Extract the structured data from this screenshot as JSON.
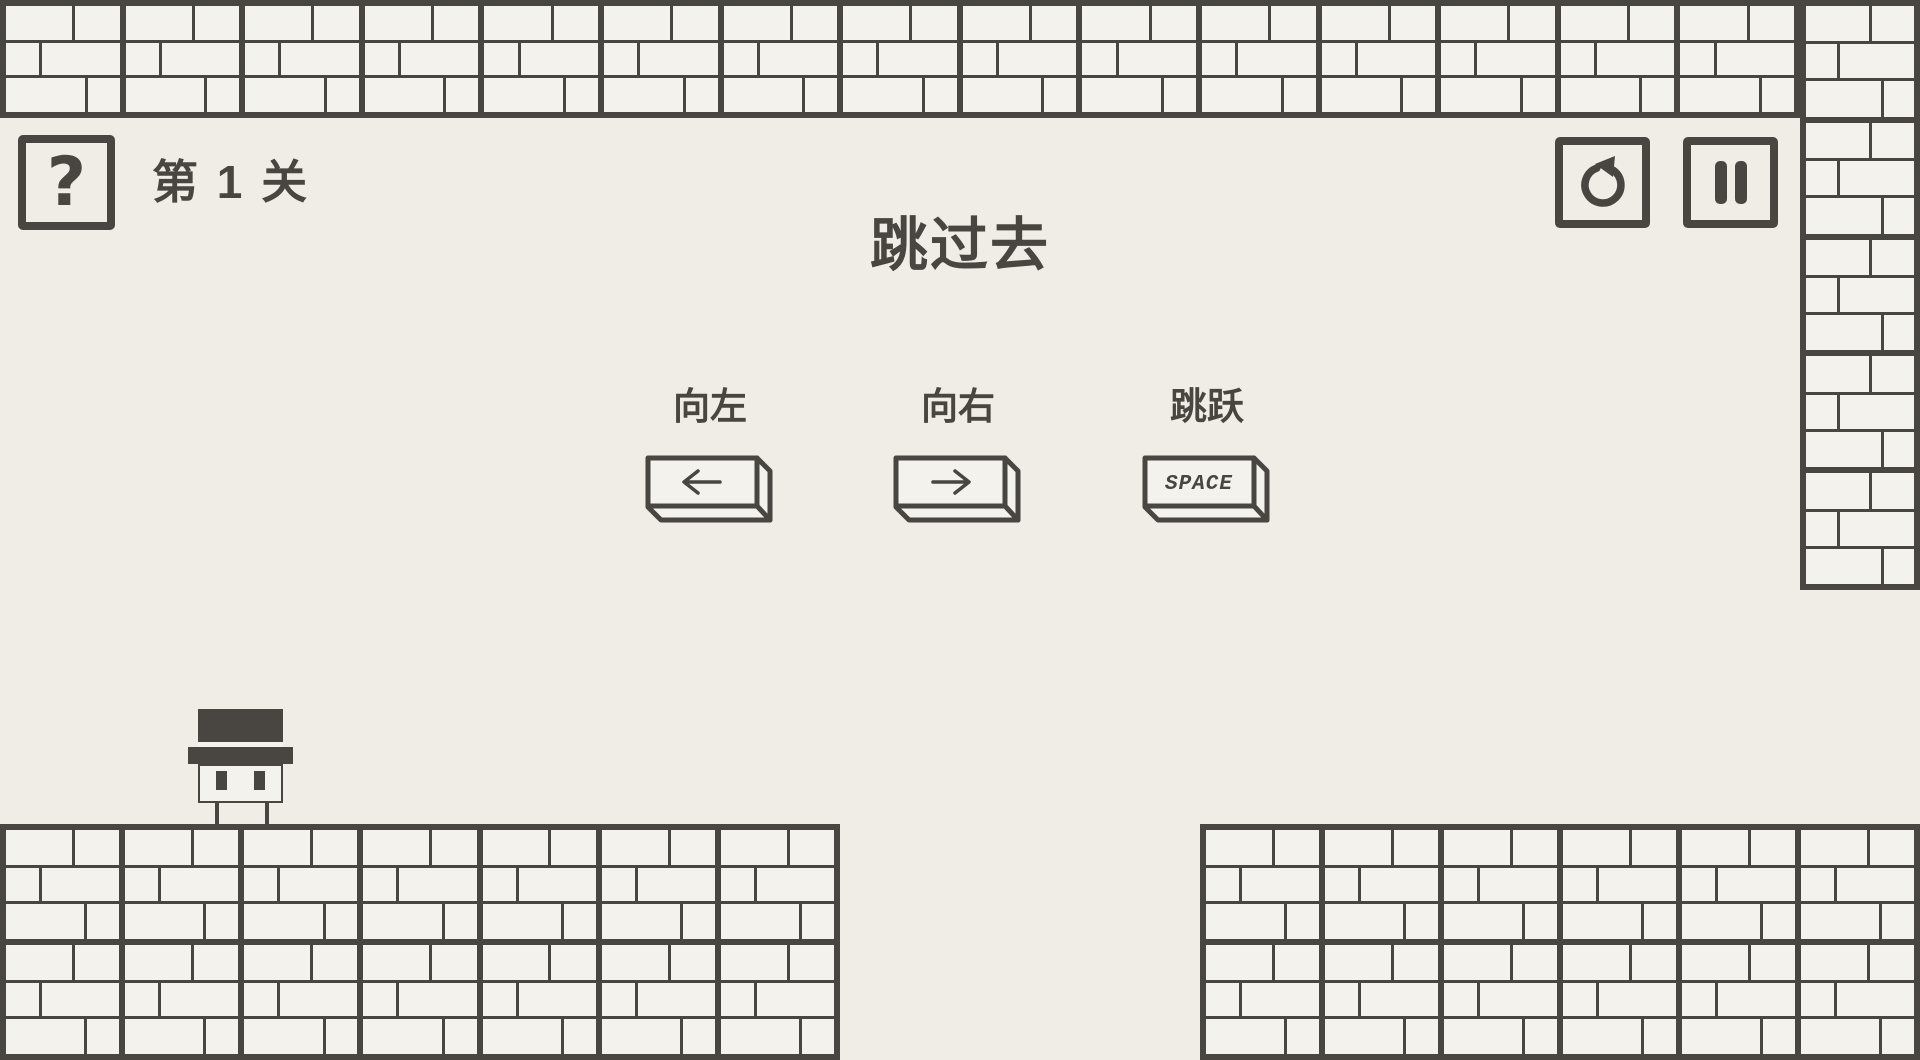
{
  "colors": {
    "background": "#f0ede7",
    "brick_fill": "#f4f2ec",
    "ink": "#494540"
  },
  "hud": {
    "help_label": "?",
    "level_label": "第 1 关",
    "title": "跳过去"
  },
  "controls": [
    {
      "label": "向左",
      "key": "left-arrow-key"
    },
    {
      "label": "向右",
      "key": "right-arrow-key"
    },
    {
      "label": "跳跃",
      "key": "space-key",
      "key_text": "SPACE"
    }
  ],
  "level": {
    "block_w": 120,
    "block_h": 118,
    "walls": [
      {
        "name": "top-wall",
        "x": 0,
        "y": 0,
        "cols": 15,
        "rows": 1
      },
      {
        "name": "right-column",
        "x": 1800,
        "y": 0,
        "cols": 1,
        "rows": 5
      },
      {
        "name": "platform-left",
        "x": 0,
        "y": 824,
        "cols": 7,
        "rows": 2
      },
      {
        "name": "platform-right",
        "x": 1200,
        "y": 824,
        "cols": 6,
        "rows": 2
      }
    ]
  }
}
